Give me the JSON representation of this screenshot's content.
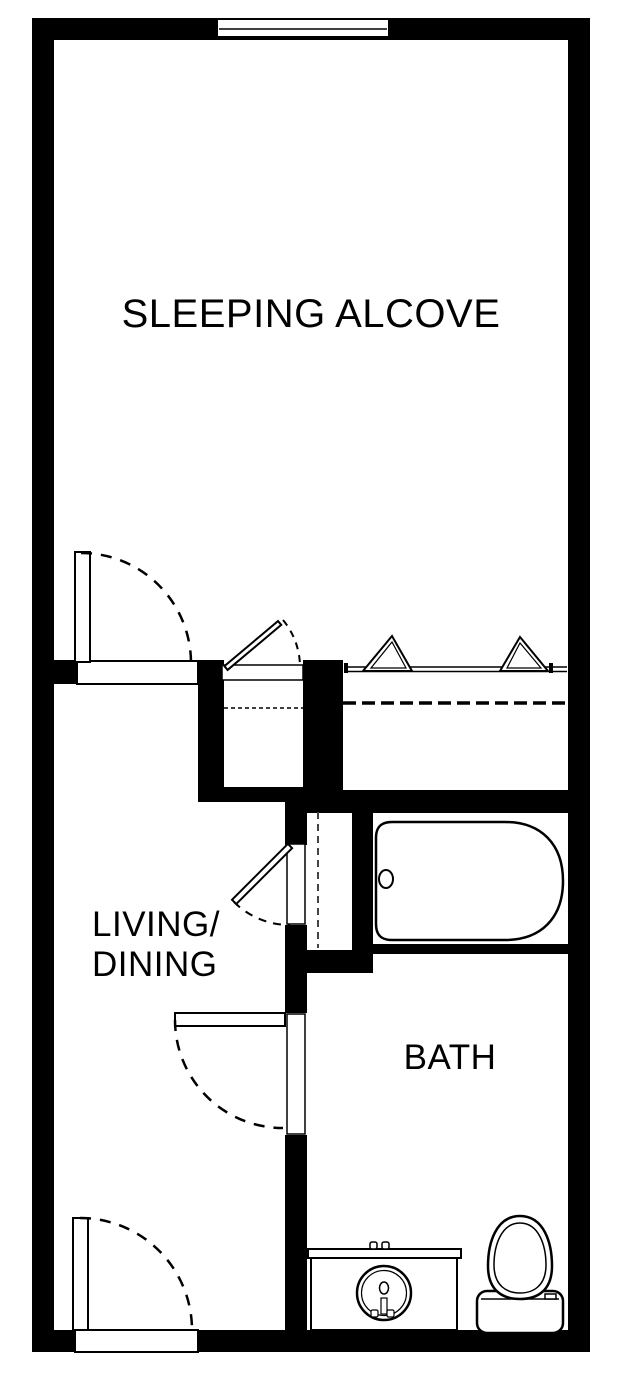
{
  "rooms": {
    "sleeping_alcove": {
      "label": "SLEEPING ALCOVE"
    },
    "living_dining": {
      "line1": "LIVING/",
      "line2": "DINING"
    },
    "bath": {
      "label": "BATH"
    }
  },
  "fixtures": {
    "window": "window",
    "entry_door": "swing-door",
    "alcove_door": "swing-door",
    "bath_door": "swing-door",
    "linen_closet_door": "swing-door",
    "middle_closet_door": "swing-door",
    "bifold_closet_doors": "bifold-doors",
    "closet_rod": "dashed-closet-rod",
    "bathtub": "bathtub",
    "sink_vanity": "sink-vanity",
    "toilet": "toilet"
  },
  "colors": {
    "wall": "#000000",
    "floor": "#ffffff",
    "line": "#000000",
    "accent_dash": "#444444"
  }
}
